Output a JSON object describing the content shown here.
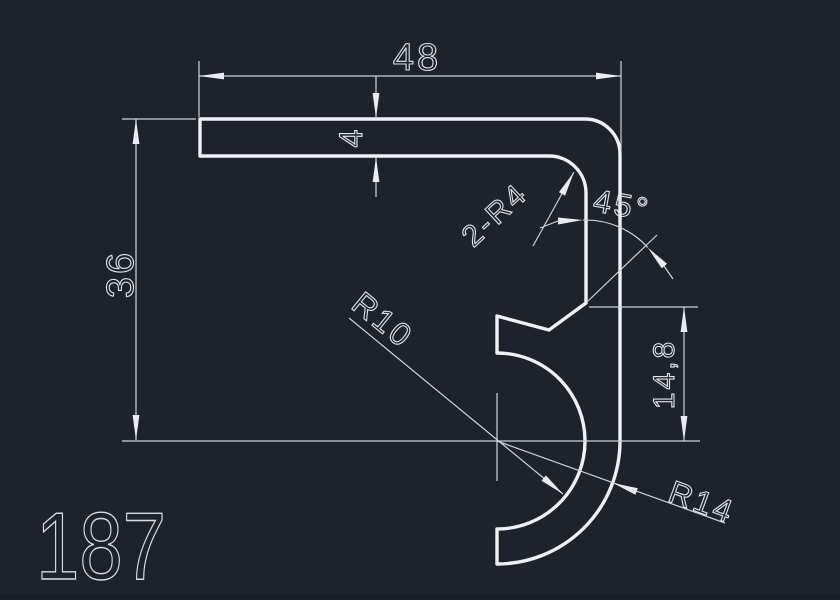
{
  "drawing": {
    "part_number": "187",
    "colors": {
      "background": "#1d222c",
      "profile_line": "#eff2f5",
      "dimension_line": "#ccd3da"
    },
    "dimensions": {
      "overall_width": "48",
      "flange_thickness": "4",
      "overall_height": "36",
      "corner_radii": "2-R4",
      "chamfer_angle": "45°",
      "hook_inner_radius": "R10",
      "notch_height": "14,8",
      "hook_outer_radius": "R14"
    }
  }
}
